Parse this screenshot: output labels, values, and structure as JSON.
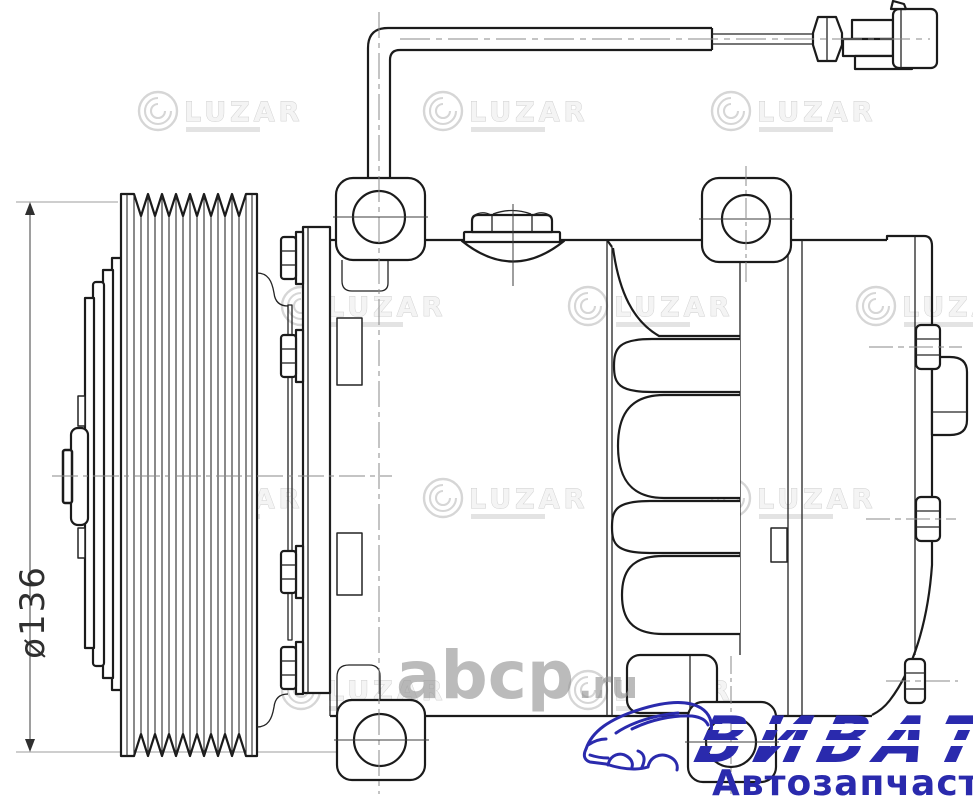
{
  "dimension": {
    "label": "ø136"
  },
  "watermarks": {
    "luzar": "LUZAR",
    "luzar_color": "#cccccc",
    "abcp": "abcp",
    "abcp_tld": ".ru",
    "abcp_color": "#919191"
  },
  "vendor_logo": {
    "brand": "ВИВАТ",
    "tagline": "Автозапчасти",
    "color": "#2a2aad"
  },
  "drawing": {
    "line_color": "#1b1b1b",
    "centerline_color": "#8a8a8a",
    "background": "#ffffff"
  }
}
